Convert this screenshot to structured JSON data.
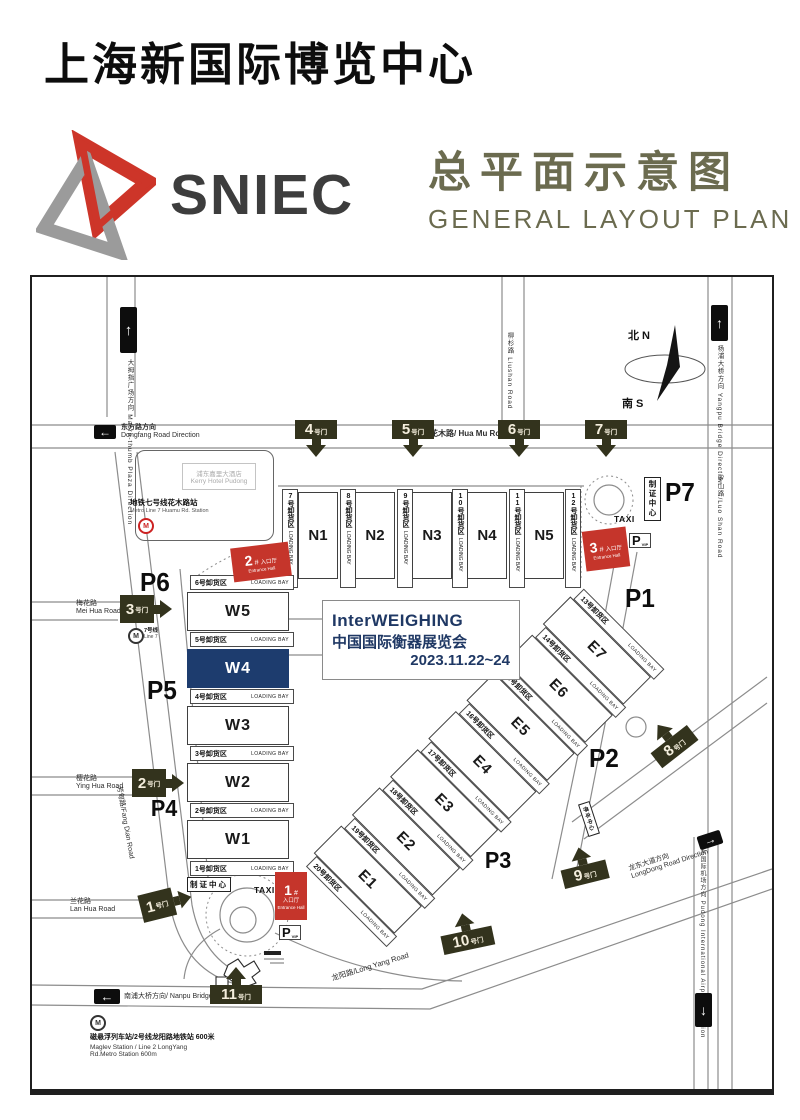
{
  "header": {
    "venue_title": "上海新国际博览中心",
    "logo_text": "SNIEC",
    "plan_title_zh": "总平面示意图",
    "plan_title_en": "GENERAL  LAYOUT  PLAN"
  },
  "colors": {
    "accent_red": "#c5352b",
    "event_navy": "#1f3864",
    "title_olive": "#6b6b4f",
    "gate_dark": "#33331d",
    "hall_highlight_bg": "#1d3c6e"
  },
  "map": {
    "labels": {
      "loading_bay": "LOADING BAY",
      "gate_suffix": "号门",
      "taxi": "TAXI",
      "p": "P",
      "vip": "VIP",
      "badge_center": "制证中心",
      "parking_center": "停车中心",
      "entrance_zh": "入口厅",
      "entrance_en": "Entrance Hall",
      "hash": "#",
      "metro_m": "M",
      "arrow_up": "↑",
      "arrow_down": "↓",
      "arrow_left": "←",
      "arrow_right": "→"
    },
    "halls": {
      "n_halls": [
        "N1",
        "N2",
        "N3",
        "N4",
        "N5"
      ],
      "n_bays": [
        "7号卸货区",
        "8号卸货区",
        "9号卸货区",
        "10号卸货区",
        "11号卸货区",
        "12号卸货区"
      ],
      "w_halls": [
        "W5",
        "W4",
        "W3",
        "W2",
        "W1"
      ],
      "w_bays": [
        "6号卸货区",
        "5号卸货区",
        "4号卸货区",
        "3号卸货区",
        "2号卸货区",
        "1号卸货区"
      ],
      "e_halls": [
        "E7",
        "E6",
        "E5",
        "E4",
        "E3",
        "E2",
        "E1"
      ],
      "e_bays": [
        "13号卸货区",
        "14号卸货区",
        "15号卸货区",
        "16号卸货区",
        "17号卸货区",
        "18号卸货区",
        "19号卸货区",
        "20号卸货区"
      ]
    },
    "parking": [
      "P1",
      "P2",
      "P3",
      "P4",
      "P5",
      "P6",
      "P7"
    ],
    "gates": [
      "1",
      "2",
      "3",
      "4",
      "5",
      "6",
      "7",
      "8",
      "9",
      "10",
      "11"
    ],
    "entrances": [
      {
        "num": "1"
      },
      {
        "num": "2"
      },
      {
        "num": "3"
      }
    ],
    "event_box": {
      "line1": "InterWEIGHING",
      "line2": "中国国际衡器展览会",
      "line3": "2023.11.22~24"
    },
    "compass": {
      "north": "北 N",
      "south": "南 S"
    },
    "roads": {
      "hua_mu": "花木路/ Hua Mu Road",
      "dongfang_zh": "东方路方向",
      "dongfang_en": "Dongfang Road Direction",
      "macro_thumb": "大拇指广场方向 Macro-thumb Plaza Direction",
      "liushan": "柳杉路 Liushan Road",
      "yangpu": "杨浦大桥方向 Yangpu Bridge Direction",
      "luoshan": "罗山路/Luo Shan Road",
      "mei_hua_zh": "梅花路",
      "mei_hua_en": "Mei Hua Road",
      "ying_hua_zh": "樱花路",
      "ying_hua_en": "Ying Hua Road",
      "lan_hua_zh": "兰花路",
      "lan_hua_en": "Lan Hua Road",
      "fang_dian": "芳甸路/Fang Dian Road",
      "nanpu": "南浦大桥方向/ Nanpu Bridge Direction",
      "long_yang": "龙阳路/Long Yang Road",
      "long_dong_zh": "龙东大道方向",
      "long_dong_en": "LongDong Road Direction",
      "airport": "浦东国际机场方向 Pudong International Airport Direction"
    },
    "stations": {
      "huamu_zh": "地铁七号线花木路站",
      "huamu_en": "Metro Line 7 Huamu Rd. Station",
      "line7_zh": "7号线",
      "line7_en": "Line 7",
      "maglev_zh": "磁悬浮列车站/2号线龙阳路地铁站  600米",
      "maglev_en1": "Maglev Station / Line 2 LongYang",
      "maglev_en2": "Rd.Metro Station 600m"
    },
    "landmarks": {
      "kerry_zh": "浦东嘉里大酒店",
      "kerry_en": "Kerry Hotel Pudong"
    }
  }
}
